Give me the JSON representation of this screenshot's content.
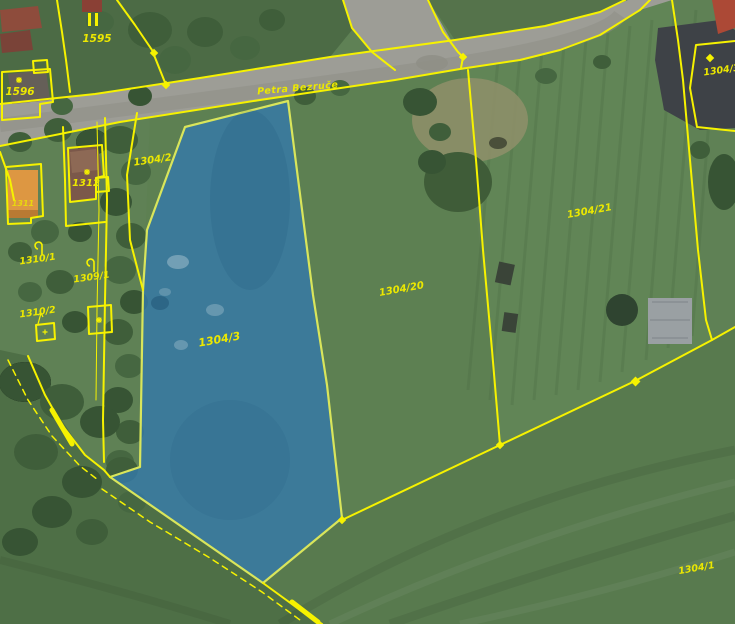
{
  "map": {
    "type": "cadastral-parcel-map-over-aerial-imagery",
    "street_label": {
      "text": "Petra Bezruče"
    },
    "selected_parcel": {
      "id": "1304/3",
      "fill": "#3579a8",
      "border": "#d9e55b"
    },
    "labels": [
      {
        "text": "1595"
      },
      {
        "text": "1596"
      },
      {
        "text": "1312"
      },
      {
        "text": "1311"
      },
      {
        "text": "1304/2"
      },
      {
        "text": "1310/1"
      },
      {
        "text": "1309/1"
      },
      {
        "text": "1310/2"
      },
      {
        "text": "1304/3"
      },
      {
        "text": "1304/20"
      },
      {
        "text": "1304/21"
      },
      {
        "text": "1304/1"
      },
      {
        "text": "1304/3"
      }
    ],
    "symbols": [
      {
        "name": "parallel-bars-symbol",
        "on_parcel": "1595"
      },
      {
        "name": "building-star-symbol",
        "on_parcel": "1596"
      },
      {
        "name": "building-star-symbol",
        "on_parcel": "1312"
      },
      {
        "name": "land-use-hook-symbol",
        "on_parcel": "1310/1"
      },
      {
        "name": "land-use-hook-symbol",
        "on_parcel": "1309/1"
      },
      {
        "name": "vertex-diamond",
        "count": 7
      },
      {
        "name": "boundary-arrow",
        "count": 2
      }
    ],
    "colors": {
      "boundary_yellow": "#f6f200",
      "label_yellow": "#ece800",
      "selection_blue": "#3579a8",
      "selection_border": "#d9e55b",
      "road_gray": "#9d9d96",
      "field_green": "#5f8155"
    }
  }
}
